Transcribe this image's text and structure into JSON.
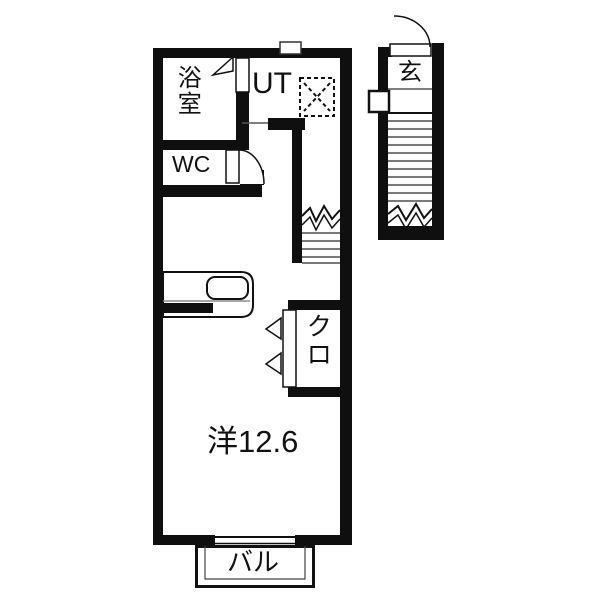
{
  "plan_title": "apartment-floorplan",
  "rooms": {
    "bathroom": "浴室",
    "utility": "UT",
    "toilet": "WC",
    "entrance": "玄",
    "closet": "クロ",
    "living": "洋12.6",
    "balcony": "バル"
  },
  "colors": {
    "wall": "#0f0f0f",
    "background": "#ffffff",
    "tread": "#7a7a7a",
    "thin_line": "#555555"
  }
}
